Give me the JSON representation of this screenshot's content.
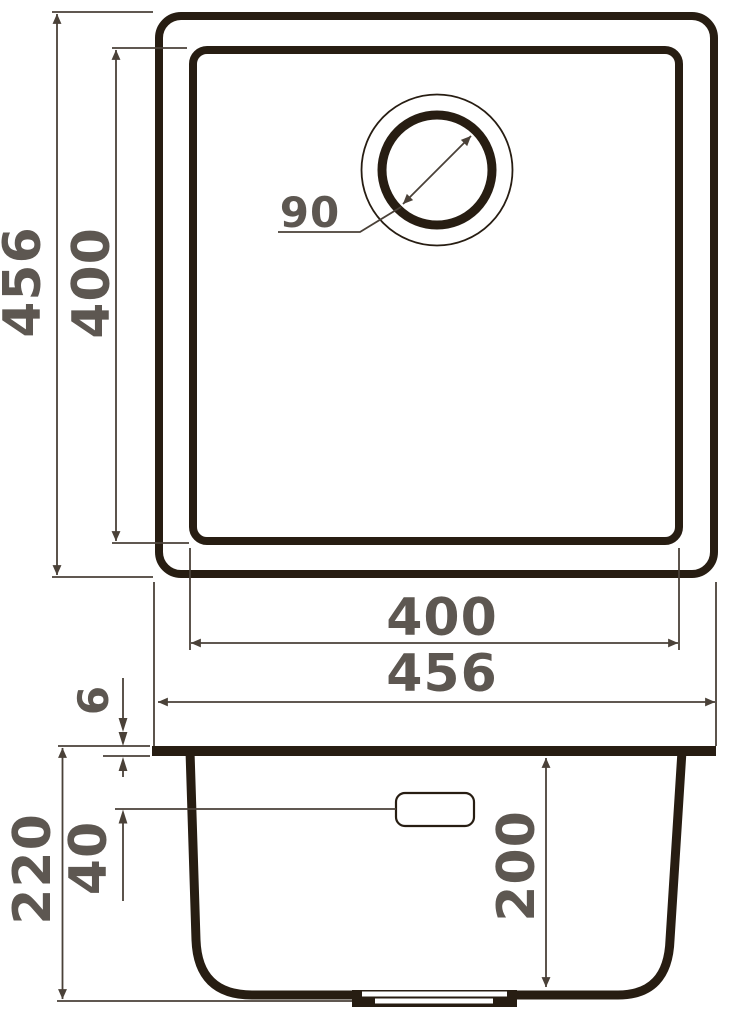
{
  "drawing": {
    "top_view": {
      "outer_width": "456",
      "outer_height": "456",
      "inner_width": "400",
      "inner_height": "400",
      "drain_diameter": "90"
    },
    "side_view": {
      "rim_thickness": "6",
      "total_depth": "220",
      "overflow_offset": "40",
      "bowl_depth": "200"
    },
    "colors": {
      "outline": "#271d12",
      "dimension_line": "#4a4138",
      "label_text": "#5d5751",
      "background": "#ffffff"
    }
  }
}
